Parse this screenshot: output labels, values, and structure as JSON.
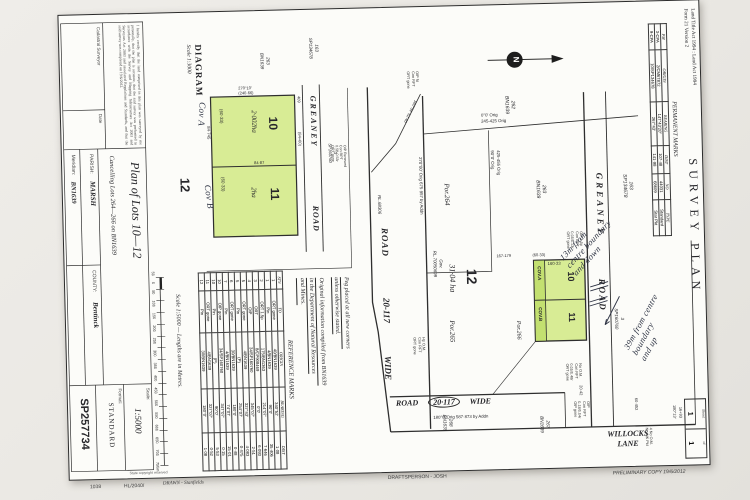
{
  "form": {
    "act_line": "Land Title Act 1994 : Land Act 1994",
    "form_line": "Form 21 Version 2",
    "title": "SURVEY PLAN",
    "sheet_label": "Sheet",
    "sheet_no": "1",
    "of_label": "of",
    "of_no": "1"
  },
  "permanent_marks": {
    "title": "PERMANENT MARKS",
    "columns": [
      "PM",
      "ORIGIN",
      "BEARING",
      "DIST",
      "NO",
      "TYPE"
    ],
    "rows": [
      {
        "pm": "3-CPA",
        "origin": "2/CM67872",
        "bearing": "147°43′20″",
        "dist": "107·48",
        "no": "44031",
        "type": "Standard"
      },
      {
        "pm": "9-CPA",
        "origin": "10/SP134678",
        "bearing": "267°43′",
        "dist": "141·98",
        "no": "68609",
        "type": "Star Pkt"
      }
    ]
  },
  "north": {
    "label": "N"
  },
  "main": {
    "greaney": "GREANEY",
    "road": "ROAD",
    "roadA": [
      "ROAD",
      "20-117",
      "WIDE"
    ],
    "roadB_road": "ROAD",
    "roadB_num": "20·117",
    "roadB_wide": "WIDE",
    "willocks": [
      "WILLOCKS",
      "LANE"
    ],
    "lot10": "10",
    "lot11": "11",
    "lot12": "12",
    "cova": "COV.A",
    "covb": "COV.B",
    "area12": "31·04 ha",
    "por265": "Por.265",
    "por264": "Por.264",
    "por266": "Por.266",
    "p163": [
      "163",
      "SP134678"
    ],
    "p263": [
      "263",
      "BN1639"
    ],
    "p262": [
      "262",
      "BN1639"
    ],
    "p267": [
      "267",
      "BN1639"
    ],
    "p268": [
      "268",
      "BN1639"
    ],
    "p3": [
      "3",
      "SP160760"
    ],
    "gov": [
      "Gov.",
      "RL.70050699"
    ],
    "rl": "RL.68306",
    "b00": [
      "0°0′ Orig",
      "245-425 Orig"
    ],
    "b90": [
      "425-455 Orig",
      "90°0′ Orig"
    ],
    "b270": "270°00′ Orig   675·957 by Addn",
    "b180": "180°0′ Orig   587·873 by Addn",
    "bdiag": "160°04′  52·40",
    "d16033": "160·33",
    "d6033": "(60·33)",
    "d167": "167-179",
    "d2042": "20·42",
    "d60452": "60·452",
    "d1693": "16+93",
    "d18013": "180°13′",
    "c1": [
      "OIP fd",
      "Con RFT",
      "ORT gone"
    ],
    "c2": [
      "OIP 1.5p",
      "Con RFT",
      "0.05/0.13r",
      "ORT gone"
    ],
    "c3": [
      "No O.M.",
      "Con RFT",
      "0.05/0.48r",
      "ORT gone"
    ],
    "c4": [
      "OIP",
      "Con RFT",
      "0.18/0.04r",
      "OIP gone"
    ],
    "c5": [
      "4 No O.M.",
      "No MK Pkt"
    ],
    "c6": [
      "Hp O.M.",
      "Con RFT",
      "ORT gone"
    ]
  },
  "diagram": {
    "title": "DIAGRAM",
    "scale": "Scale 1:3000",
    "greaney": "GREANEY",
    "road": "ROAD",
    "lot10": "10",
    "a10": "2·002ha",
    "lot11": "11",
    "a11": "2ha",
    "lot12": "12",
    "p163": [
      "163",
      "SP134678"
    ],
    "p263": [
      "263",
      "BN1639"
    ],
    "p3": [
      "3",
      "SP160760"
    ],
    "d1": "(60·33)",
    "d2": "(60·33)",
    "d3": "409",
    "d4": "84·745",
    "d5": "84·87",
    "d6": "(84+60)",
    "dleft": [
      "270°10′",
      "(240·66)"
    ],
    "hw_a": "Cov A",
    "hw_b": "Cov B",
    "corner": [
      "OIP Renewed",
      "Con RPT",
      "0.5B 0.53r",
      "ORT gone"
    ]
  },
  "notes": {
    "n1": [
      "Peg placed at all new corners",
      "unless otherwise stated."
    ],
    "n2": [
      "Original information compiled from BN1639",
      "in the Department of Natural Resources",
      "and Mines."
    ]
  },
  "reference_marks": {
    "title": "REFERENCE MARKS",
    "columns": [
      "STN",
      "TO",
      "ORIGIN",
      "BEARING",
      "DIST"
    ],
    "rows": [
      {
        "stn": "1",
        "to": "ORT gone",
        "origin": "40/BN1639",
        "bearing": "340°52′",
        "dist": "1·08"
      },
      {
        "stn": "1",
        "to": "Pin",
        "origin": "4/BN1639",
        "bearing": "90°0′",
        "dist": "35·406"
      },
      {
        "stn": "2",
        "to": "ORT 1.5p",
        "origin": "175/BN1363",
        "bearing": "214°07′",
        "dist": "7·646"
      },
      {
        "stn": "3",
        "to": "ORT",
        "origin": "8/CP908469",
        "bearing": "0°0′",
        "dist": "6·093"
      },
      {
        "stn": "4",
        "to": "OIP",
        "origin": "34/SP160760",
        "bearing": "345°07′",
        "dist": "2·51"
      },
      {
        "stn": "5",
        "to": "ORT gone",
        "origin": "4/BN1639",
        "bearing": "327°43′",
        "dist": "4·083"
      },
      {
        "stn": "5",
        "to": "Pin",
        "origin": "(P)",
        "bearing": "254°07′",
        "dist": "0·475"
      },
      {
        "stn": "6",
        "to": "ORT gone",
        "origin": "30/BN1639",
        "bearing": "180°0′",
        "dist": "0·48"
      },
      {
        "stn": "7",
        "to": "Pin",
        "origin": "4/BN1639",
        "bearing": "74°07′",
        "dist": "15·01"
      },
      {
        "stn": "10",
        "to": "OIP gone",
        "origin": "34/SP160760",
        "bearing": "347°07′",
        "dist": "0·15"
      },
      {
        "stn": "10",
        "to": "Pin",
        "origin": "(P)",
        "bearing": "90°0′",
        "dist": "5·53"
      },
      {
        "stn": "11",
        "to": "ORT gone",
        "origin": "4/BN1639",
        "bearing": "327°07′",
        "dist": "0·52"
      },
      {
        "stn": "12",
        "to": "Pin",
        "origin": "30/BN1639",
        "bearing": "180°0′",
        "dist": "1·08"
      }
    ]
  },
  "scale_bar": {
    "caption": "Scale 1:5000 — Lengths are in Metres.",
    "ticks": [
      "50",
      "0",
      "50",
      "100",
      "150",
      "200",
      "250",
      "300",
      "350",
      "400",
      "450",
      "500",
      "550",
      "600",
      "650",
      "700",
      "750m"
    ],
    "copyright": "State copyright reserved"
  },
  "title_block": {
    "plan_title": "Plan of Lots 10—12",
    "cancelling": "Cancelling Lots 264—266 on BN1639",
    "parish_label": "PARISH:",
    "parish": "MARSH",
    "county_label": "COUNTY:",
    "county": "Bentinck",
    "meridian_label": "Meridian:",
    "meridian": "BN1639",
    "scale_label": "Scale:",
    "scale": "1:5000",
    "format_label": "Format:",
    "format": "STANDARD",
    "number": "SP257734",
    "cert": "I hereby certify that the land comprised in this plan was surveyed by me personally, that the plan is accurate, that the said survey was performed in accordance with the Survey and Mapping Infrastructure Act 2003 and Surveyors Act 2003 and associated Regulations and Standards, and that the said survey was completed on 19/6/2012.",
    "surveyor_label": "Cadastral Surveyor",
    "date_label": "Date"
  },
  "handwriting": {
    "h1": [
      "13m from",
      "centre boundary",
      "and down"
    ],
    "h2": [
      "39m from centre",
      "boundary",
      "and up"
    ]
  },
  "footer": {
    "n1": "1038",
    "n2": "HL/2040/",
    "drawn": "DRAWN - Stanfields",
    "drafts": "DRAFTSPERSON - JOSH",
    "prelim": "PRELIMINARY COPY   19/6/2012"
  }
}
